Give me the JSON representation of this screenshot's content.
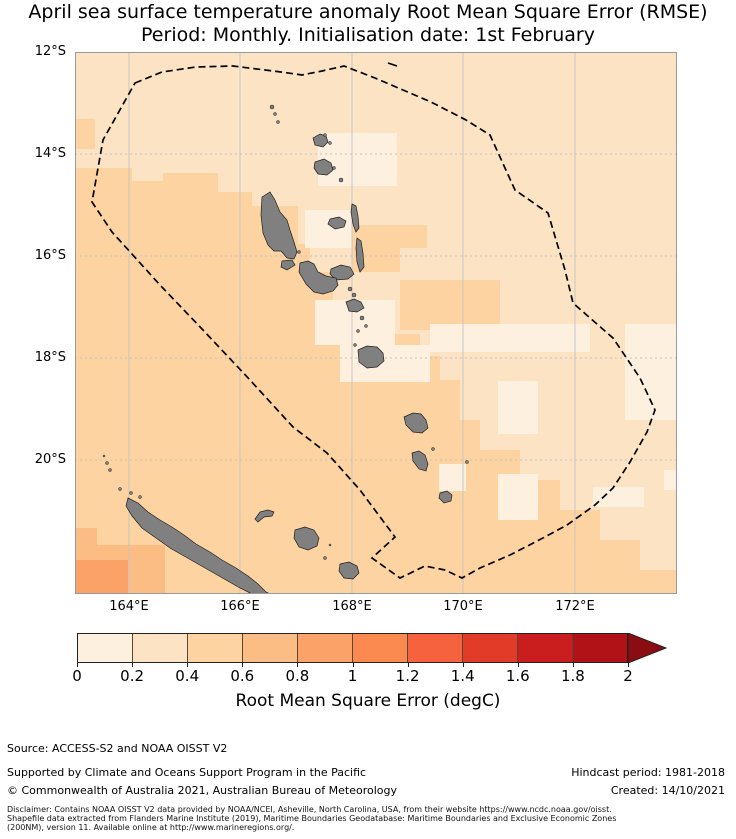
{
  "title": {
    "line1": "April sea surface temperature anomaly Root Mean Square Error (RMSE)",
    "line2": "Period: Monthly. Initialisation date: 1st February"
  },
  "axes": {
    "lat_ticks": [
      {
        "label": "12°S",
        "y": 52
      },
      {
        "label": "14°S",
        "y": 154
      },
      {
        "label": "16°S",
        "y": 256
      },
      {
        "label": "18°S",
        "y": 358
      },
      {
        "label": "20°S",
        "y": 460
      }
    ],
    "lon_ticks": [
      {
        "label": "164°E",
        "x": 129
      },
      {
        "label": "166°E",
        "x": 240
      },
      {
        "label": "168°E",
        "x": 352
      },
      {
        "label": "170°E",
        "x": 463
      },
      {
        "label": "172°E",
        "x": 575
      }
    ]
  },
  "colorbar": {
    "label": "Root Mean Square Error (degC)",
    "ticks": [
      "0",
      "0.2",
      "0.4",
      "0.6",
      "0.8",
      "1",
      "1.2",
      "1.4",
      "1.6",
      "1.8",
      "2"
    ],
    "colors": [
      "#fdf0de",
      "#fbe3c3",
      "#fcd3a1",
      "#fcbd85",
      "#faa268",
      "#fb8a51",
      "#f6613e",
      "#e23c28",
      "#ca1d1e",
      "#b11218"
    ],
    "arrow_color": "#8a0d12",
    "range": [
      0,
      2
    ]
  },
  "footer": {
    "source": "Source: ACCESS-S2 and NOAA OISST V2",
    "supported": "Supported by Climate and Oceans Support Program in the Pacific",
    "copyright": "© Commonwealth of Australia 2021, Australian Bureau of Meteorology",
    "hindcast": "Hindcast period: 1981-2018",
    "created": "Created: 14/10/2021",
    "disclaimer1": "Disclaimer: Contains NOAA OISST V2 data provided by NOAA/NCEI, Asheville, North Carolina, USA, from their website https://www.ncdc.noaa.gov/oisst.",
    "disclaimer2": "Shapefile data extracted from Flanders Marine Institute (2019), Maritime Boundaries Geodatabase: Maritime Boundaries and Exclusive Economic Zones",
    "disclaimer3": "(200NM), version 11. Available online at http://www.marineregions.org/."
  },
  "map_data": {
    "bounds_px": {
      "x": 75,
      "y": 52,
      "w": 602,
      "h": 542
    },
    "lon_range": [
      163.0,
      174.0
    ],
    "lat_range": [
      -22.6,
      -12.0
    ],
    "colors": {
      "b1": "#fdf0de",
      "b2": "#fbe3c3",
      "b3": "#fcd3a1",
      "b4": "#fcbd85",
      "b5": "#faa268",
      "land": "#808080",
      "land_stroke": "#1f1f1f",
      "grid": "#c4c4c4",
      "frame": "#9a9a9a",
      "eez": "#000000"
    },
    "base_color": "b2",
    "c3_polygon": "M75,168 L132,168 132,181 163,181 163,173 218,173 218,192 252,192 252,206 298,206 298,244 310,244 310,272 333,272 333,314 355,314 355,334 420,334 420,356 440,356 440,380 460,380 460,420 480,420 480,450 520,450 520,480 560,480 560,510 600,510 600,540 640,540 640,570 677,570 677,594 75,594 Z",
    "patches": [
      {
        "x": 75,
        "y": 119,
        "w": 20,
        "h": 30,
        "color": "b3"
      },
      {
        "x": 352,
        "y": 225,
        "w": 75,
        "h": 23,
        "color": "b3"
      },
      {
        "x": 352,
        "y": 248,
        "w": 48,
        "h": 24,
        "color": "b3"
      },
      {
        "x": 400,
        "y": 280,
        "w": 100,
        "h": 50,
        "color": "b3"
      },
      {
        "x": 318,
        "y": 133,
        "w": 79,
        "h": 53,
        "color": "b1"
      },
      {
        "x": 305,
        "y": 210,
        "w": 47,
        "h": 38,
        "color": "b1"
      },
      {
        "x": 315,
        "y": 300,
        "w": 80,
        "h": 45,
        "color": "b1"
      },
      {
        "x": 340,
        "y": 345,
        "w": 90,
        "h": 37,
        "color": "b1"
      },
      {
        "x": 430,
        "y": 324,
        "w": 160,
        "h": 28,
        "color": "b1"
      },
      {
        "x": 498,
        "y": 381,
        "w": 40,
        "h": 53,
        "color": "b1"
      },
      {
        "x": 625,
        "y": 324,
        "w": 52,
        "h": 96,
        "color": "b1"
      },
      {
        "x": 439,
        "y": 464,
        "w": 27,
        "h": 27,
        "color": "b1"
      },
      {
        "x": 498,
        "y": 474,
        "w": 40,
        "h": 46,
        "color": "b1"
      },
      {
        "x": 593,
        "y": 487,
        "w": 51,
        "h": 20,
        "color": "b1"
      },
      {
        "x": 664,
        "y": 470,
        "w": 13,
        "h": 20,
        "color": "b1"
      },
      {
        "x": 75,
        "y": 528,
        "w": 22,
        "h": 66,
        "color": "b4"
      },
      {
        "x": 75,
        "y": 545,
        "w": 90,
        "h": 49,
        "color": "b4"
      },
      {
        "x": 75,
        "y": 560,
        "w": 53,
        "h": 34,
        "color": "b5"
      }
    ],
    "eez_path": "M135,83 L162,72 196,67 233,66 265,70 281,72 302,75 322,71 344,66 375,78 403,90 431,102 466,120 490,135 515,190 548,213 565,270 573,303 613,338 640,378 655,410 647,432 630,462 613,488 595,505 567,525 543,538 510,555 480,568 462,578 445,570 425,566 400,578 372,558 395,537 360,490 327,453 293,427 250,380 203,330 160,285 112,232 92,202 103,140 Z",
    "eez_extra": "M388,63 l9,3",
    "islands": [
      {
        "name": "espiritu-santo",
        "d": "M262,197 L270,192 275,200 280,212 287,220 290,230 294,242 297,252 294,259 287,258 281,251 274,251 268,245 263,233 261,215 Z"
      },
      {
        "name": "malo",
        "d": "M282,261 l10,-1 3,5 -8,5 -6,-3 Z"
      },
      {
        "name": "maewo",
        "d": "M352,204 l4,2 2,10 1,12 -3,4 -3,-8 -2,-12 Z"
      },
      {
        "name": "pentecost",
        "d": "M357,238 l4,3 2,12 1,14 -4,5 -3,-10 -1,-14 Z"
      },
      {
        "name": "ambae",
        "d": "M330,219 l9,-2 7,4 -2,6 -9,2 -7,-5 Z"
      },
      {
        "name": "ambrym",
        "d": "M331,269 l10,-4 9,2 4,7 -6,5 -12,1 -6,-6 Z"
      },
      {
        "name": "malekula",
        "d": "M300,263 l8,-2 6,3 4,8 8,4 10,2 2,7 -5,6 -10,3 -9,-2 -8,-8 -7,-12 Z"
      },
      {
        "name": "epi",
        "d": "M346,302 l8,-3 7,3 3,6 -7,4 -8,-1 Z"
      },
      {
        "name": "efate",
        "d": "M358,350 l9,-4 10,1 6,6 1,8 -7,6 -10,1 -8,-6 Z"
      },
      {
        "name": "erromango",
        "d": "M404,417 l9,-4 8,1 5,6 2,8 -6,5 -9,-1 -7,-7 Z"
      },
      {
        "name": "tanna",
        "d": "M412,453 l7,-2 6,4 3,9 -2,7 -7,-2 -6,-8 Z"
      },
      {
        "name": "aneityum",
        "d": "M440,493 l7,-2 5,4 -1,6 -7,2 -5,-5 Z"
      },
      {
        "name": "vanua-lava",
        "d": "M313,138 l7,-4 6,2 2,6 -5,5 -8,-2 Z"
      },
      {
        "name": "gaua",
        "d": "M315,162 l9,-3 7,4 2,7 -6,5 -9,-1 -4,-6 Z"
      },
      {
        "name": "new-caledonia",
        "d": "M128,498 L138,503 148,512 160,520 172,527 184,535 196,544 210,552 222,560 236,568 248,576 258,584 266,592 270,594 252,594 240,588 226,580 212,572 198,564 184,556 170,548 156,538 142,528 132,516 126,506 Z"
      },
      {
        "name": "ouvea",
        "d": "M260,512 l8,-2 6,2 -2,4 -8,1 -6,5 -3,-3 Z"
      },
      {
        "name": "lifou",
        "d": "M295,530 l10,-3 9,3 5,8 -2,8 -9,4 -9,-3 -5,-9 Z"
      },
      {
        "name": "mare",
        "d": "M340,564 l9,-2 8,4 2,7 -6,6 -9,-1 -5,-7 Z"
      }
    ],
    "island_dots": [
      [
        272,
        107,
        2
      ],
      [
        275,
        114,
        1.5
      ],
      [
        278,
        122,
        1.5
      ],
      [
        325,
        135,
        1.5
      ],
      [
        330,
        143,
        1.5
      ],
      [
        334,
        168,
        1.5
      ],
      [
        341,
        180,
        2
      ],
      [
        299,
        252,
        1.5
      ],
      [
        350,
        289,
        2
      ],
      [
        354,
        295,
        2
      ],
      [
        362,
        318,
        2
      ],
      [
        366,
        326,
        1.5
      ],
      [
        358,
        331,
        1.5
      ],
      [
        355,
        345,
        1.5
      ],
      [
        433,
        449,
        1.5
      ],
      [
        467,
        462,
        1.5
      ],
      [
        104,
        456,
        1
      ],
      [
        107,
        463,
        1.5
      ],
      [
        110,
        470,
        1.5
      ],
      [
        120,
        489,
        1.5
      ],
      [
        131,
        493,
        1.5
      ],
      [
        140,
        497,
        1.5
      ],
      [
        325,
        558,
        1.5
      ],
      [
        330,
        545,
        1
      ]
    ]
  }
}
